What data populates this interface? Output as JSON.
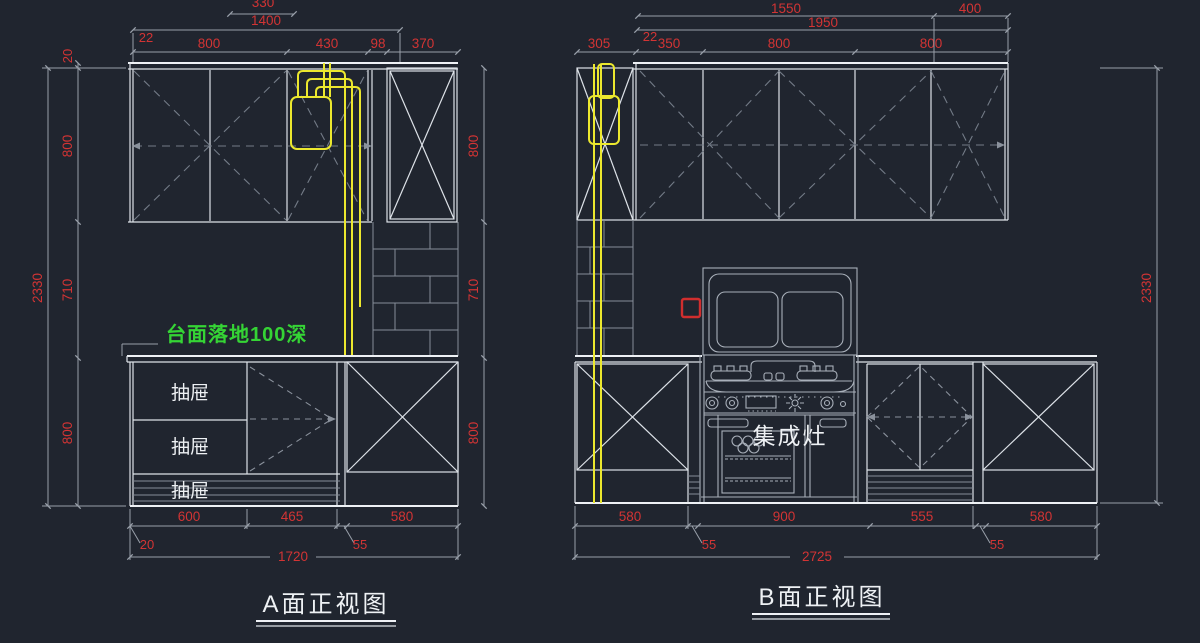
{
  "canvas": {
    "background": "#20252f"
  },
  "colors": {
    "dimension_text": "#d23434",
    "cabinet_line": "#dde2e8",
    "hidden_line_gray": "#737b87",
    "pipe_yellow": "#ece82e",
    "note_green": "#35d435",
    "socket_red": "#d02e2e"
  },
  "icons": {
    "socket": "power-socket-icon"
  },
  "view_a": {
    "title": "A面正视图",
    "note": "台面落地100深",
    "drawers": [
      "抽屉",
      "抽屉",
      "抽屉"
    ],
    "dims": {
      "top_partial": "330",
      "width_1400": "1400",
      "offset_22": "22",
      "top_segs": [
        "800",
        "430",
        "98",
        "370"
      ],
      "left_offset_20": "20",
      "height_total": "2330",
      "left_segs": [
        "800",
        "710",
        "800"
      ],
      "right_segs": [
        "800",
        "710",
        "800"
      ],
      "bottom_segs": [
        "600",
        "465",
        "580"
      ],
      "bottom_offset_20": "20",
      "bottom_offset_55": "55",
      "width_total": "1720"
    }
  },
  "view_b": {
    "title": "B面正视图",
    "stove_label": "集成灶",
    "dims": {
      "top_row1": [
        "1550",
        "400"
      ],
      "width_1950": "1950",
      "offset_22": "22",
      "top_segs": [
        "305",
        "350",
        "800",
        "800"
      ],
      "height_total": "2330",
      "bottom_segs": [
        "580",
        "900",
        "555",
        "580"
      ],
      "bottom_offset_55_left": "55",
      "bottom_offset_55_right": "55",
      "width_total": "2725"
    }
  }
}
